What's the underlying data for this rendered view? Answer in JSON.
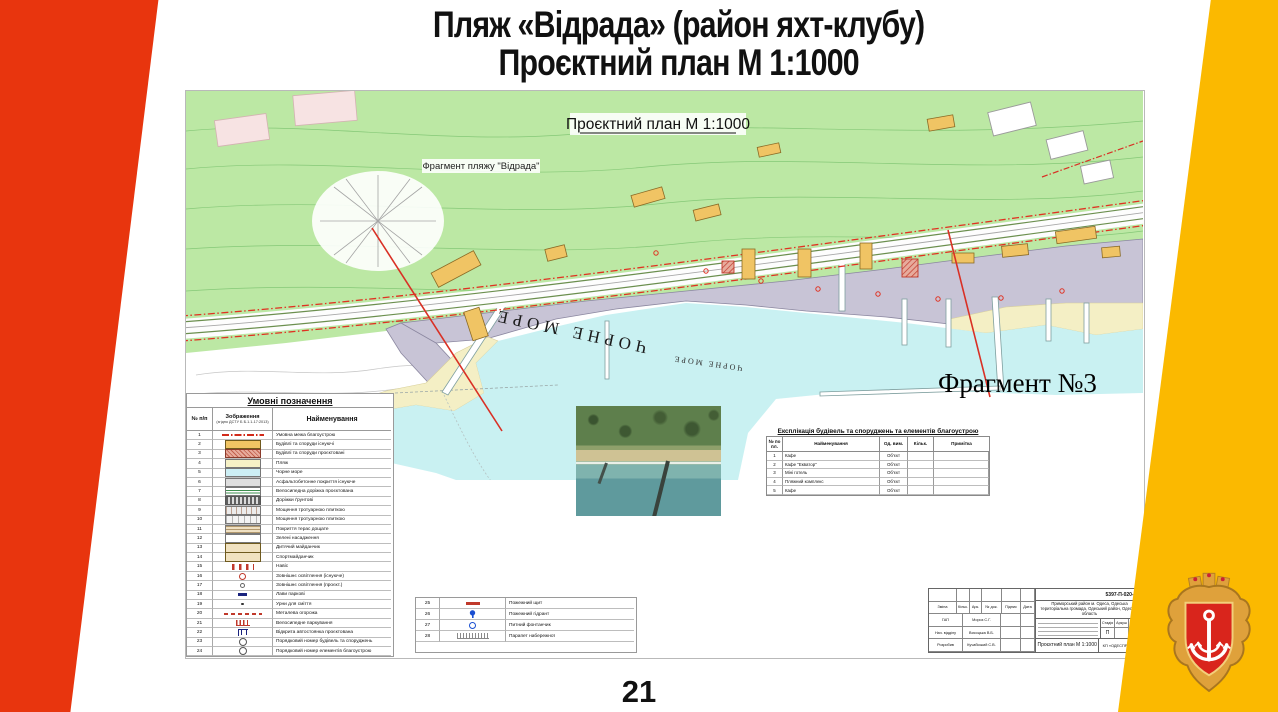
{
  "slide": {
    "title_line1": "Пляж «Відрада» (район яхт-клубу)",
    "title_line2": "Проєктний план М 1:1000",
    "page_number": "21",
    "colors": {
      "left_band": "#E8350E",
      "right_band": "#FBB900",
      "crest_red": "#D9251C",
      "crest_gold": "#DFA13B"
    }
  },
  "map": {
    "plan_title": "Проєктний план М 1:1000",
    "fragment_label": "Фрагмент пляжу \"Відрада\"",
    "sea_label_large": "ЧОРНЕ МОРЕ",
    "sea_label_small": "ЧОРНЕ МОРЕ",
    "fragment_callout": "Фрагмент №3",
    "colors": {
      "terrain_green": "#BCE8A4",
      "sea_cyan": "#C9F1F2",
      "beach_sand": "#F4EFC5",
      "promenade_gray": "#C8C4D6",
      "building_tan": "#F0C464",
      "boundary_red": "#E03222"
    }
  },
  "legend": {
    "title": "Умовні позначення",
    "col_num": "№ п/п",
    "col_symbol": "Зображення",
    "col_symbol_note": "(згідно ДСТУ Б Б.1.1-17:2013)",
    "col_name": "Найменування",
    "rows": [
      {
        "num": "1",
        "symbol": "red-dashdot-line",
        "name": "Умовна межа благоустрою"
      },
      {
        "num": "2",
        "symbol": "tan-rect",
        "name": "Будівлі та споруди існуючі"
      },
      {
        "num": "3",
        "symbol": "hatched-rect",
        "name": "Будівлі та споруди проєктовані"
      },
      {
        "num": "4",
        "symbol": "beach-rect",
        "name": "Пляж"
      },
      {
        "num": "5",
        "symbol": "sea-rect",
        "name": "Чорне море"
      },
      {
        "num": "6",
        "symbol": "gray-rect",
        "name": "Асфальтобетонне покриття існуюче"
      },
      {
        "num": "7",
        "symbol": "green-striped-rect",
        "name": "Велосипедна доріжка проєктована"
      },
      {
        "num": "8",
        "symbol": "dark-hatch-rect",
        "name": "Доріжки ґрунтові"
      },
      {
        "num": "9",
        "symbol": "paver-rect",
        "name": "Мощення тротуарною плиткою"
      },
      {
        "num": "10",
        "symbol": "paver-rect-2",
        "name": "Мощення тротуарною плиткою"
      },
      {
        "num": "11",
        "symbol": "plank-rect",
        "name": "Покриття терас дощате"
      },
      {
        "num": "12",
        "symbol": "green-rect",
        "name": "Зелені насадження"
      },
      {
        "num": "13",
        "symbol": "tan-light-rect",
        "name": "Дитячий майданчик"
      },
      {
        "num": "14",
        "symbol": "tan-light-rect",
        "name": "Спортмайданчик"
      },
      {
        "num": "15",
        "symbol": "red-brackets",
        "name": "Навіс"
      },
      {
        "num": "16",
        "symbol": "red-circle",
        "name": "Зовнішнє освітлення (існуюче)"
      },
      {
        "num": "17",
        "symbol": "small-circle",
        "name": "Зовнішнє освітлення (проєкт.)"
      },
      {
        "num": "18",
        "symbol": "navy-dash",
        "name": "Лави паркові"
      },
      {
        "num": "19",
        "symbol": "dot",
        "name": "Урни для сміття"
      },
      {
        "num": "20",
        "symbol": "red-ticks",
        "name": "Металева огорожа"
      },
      {
        "num": "21",
        "symbol": "red-comb",
        "name": "Велосипедне паркування"
      },
      {
        "num": "22",
        "symbol": "parking-symbol",
        "name": "Відкрита автостоянка проєктована"
      },
      {
        "num": "23",
        "symbol": "circled-number",
        "name": "Порядковий номер будівель та споруджень"
      },
      {
        "num": "24",
        "symbol": "circled-number-2",
        "name": "Порядковий номер елементів благоустрою"
      }
    ],
    "rows2": [
      {
        "num": "25",
        "symbol": "red-bar",
        "name": "Пожежний щит"
      },
      {
        "num": "26",
        "symbol": "hydrant",
        "name": "Пожежний гідрант"
      },
      {
        "num": "27",
        "symbol": "fountain",
        "name": "Питний фонтанчик"
      },
      {
        "num": "28",
        "symbol": "parapet",
        "name": "Парапет набережної"
      }
    ]
  },
  "explication": {
    "title": "Експлікація будівель та споруджень та елементів благоустрою",
    "col_num": "№ по пл.",
    "col_name": "Найменування",
    "col_unit": "Од. вим.",
    "col_qty": "Кільк.",
    "col_note": "Примітка",
    "rows": [
      {
        "num": "1",
        "name": "Кафе",
        "unit": "Об'єкт",
        "qty": "",
        "note": ""
      },
      {
        "num": "2",
        "name": "Кафе \"Екватор\"",
        "unit": "Об'єкт",
        "qty": "",
        "note": ""
      },
      {
        "num": "3",
        "name": "Міні готель",
        "unit": "Об'єкт",
        "qty": "",
        "note": ""
      },
      {
        "num": "4",
        "name": "Пляжний комплекс",
        "unit": "Об'єкт",
        "qty": "",
        "note": ""
      },
      {
        "num": "5",
        "name": "Кафе",
        "unit": "Об'єкт",
        "qty": "",
        "note": ""
      }
    ]
  },
  "title_block": {
    "doc_number": "5397-П-020-ГП",
    "location": "Приморський район м. Одеса, Одеська територіальна громада, Одеський район, Одеська область",
    "header_cells": [
      "Зміна",
      "Кільк.",
      "Арк.",
      "№ док.",
      "Підпис",
      "Дата"
    ],
    "sign_rows": [
      {
        "role": "ГАП",
        "name": "Мороз С.Г."
      },
      {
        "role": "Нач. відділу",
        "name": "Висоцька В.Б."
      },
      {
        "role": "Розробив",
        "name": "Кучабський С.В."
      }
    ],
    "stage_label": "Стадія",
    "sheet_label": "Аркуш",
    "sheets_label": "Арк.",
    "stage_value": "П",
    "drawing_title": "Проєктний план М 1:1000",
    "organization": "КП «ОДЕСПРОЄКТ»"
  }
}
